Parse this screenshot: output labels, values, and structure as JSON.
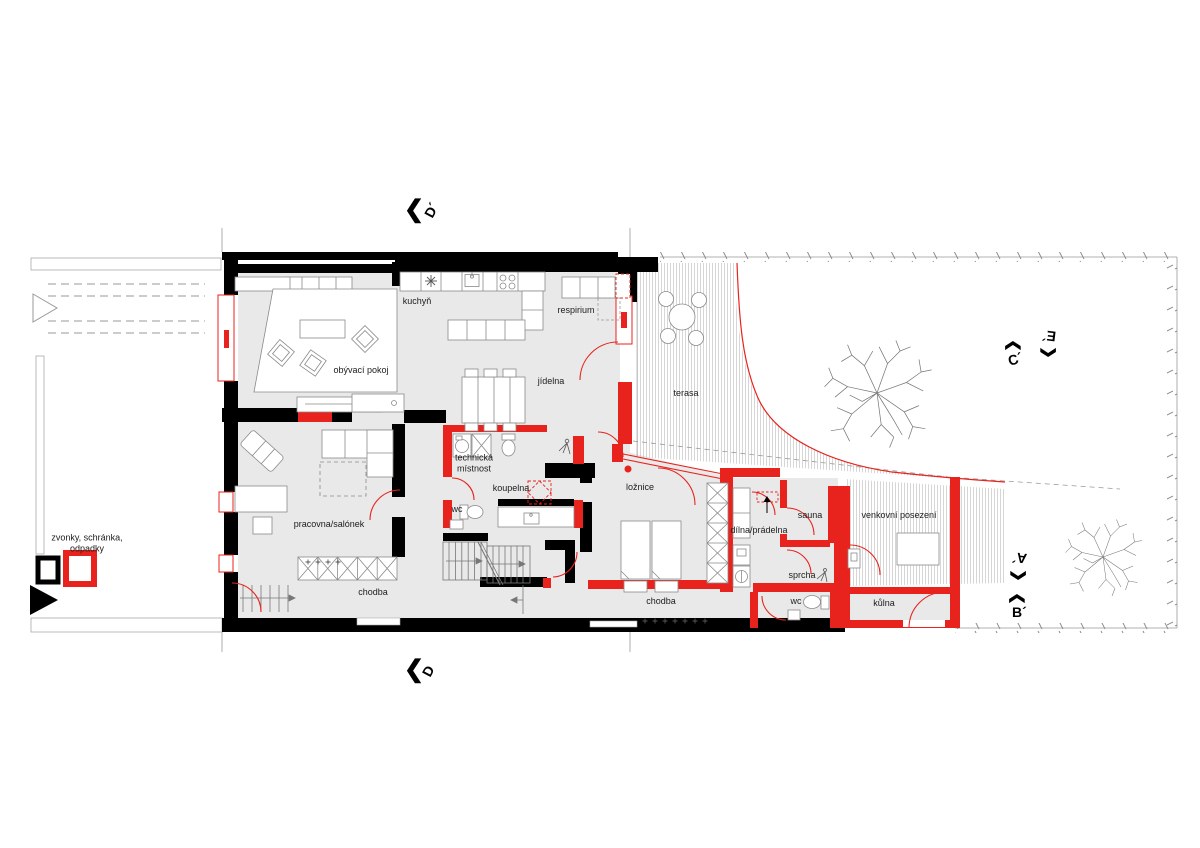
{
  "plan": {
    "rooms": {
      "kuchyn": "kuchyň",
      "obyvaci_pokoj": "obývací pokoj",
      "respirium": "respirium",
      "jidelna": "jídelna",
      "terasa": "terasa",
      "pracovna": "pracovna/salónek",
      "technicka": "technická\nmístnost",
      "koupelna": "koupelna",
      "wc_left": "wc",
      "loznice": "ložnice",
      "chodba_left": "chodba",
      "chodba_right": "chodba",
      "dilna": "dílna/prádelna",
      "sauna": "sauna",
      "sprcha": "sprcha",
      "wc_right": "wc",
      "kulna": "kůlna",
      "venkovni": "venkovní posezení"
    },
    "annotations": {
      "zvonky": "zvonky, schránka,\nodpadky"
    },
    "sections": {
      "d_top": "D´",
      "d_bottom": "D",
      "c": "C´",
      "e": "E´",
      "a": "A´",
      "b": "B´"
    },
    "icons": {
      "section_chevron": "❮"
    },
    "colors": {
      "wall": "#000000",
      "new_construction": "#e8231d",
      "floor": "#e9e9e9",
      "line": "#9a9a9a"
    }
  }
}
